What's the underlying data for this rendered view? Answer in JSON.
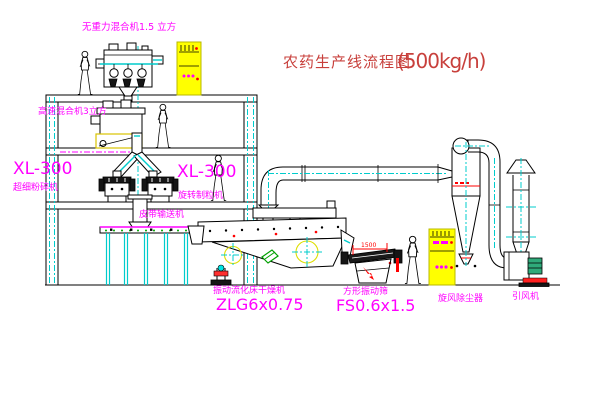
{
  "title": {
    "name": "农药生产线流程图",
    "capacity": "(500kg/h)"
  },
  "equipment_labels": {
    "zero_gravity_mixer": "无重力混合机1.5 立方",
    "high_speed_mixer": "高速混合机3立方",
    "pulverizer_model": "XL-300",
    "pulverizer_name": "超细粉碎机",
    "granulator_model": "XL-300",
    "granulator_name": "旋转制粒机",
    "belt_conveyor": "皮带输送机",
    "dryer_name": "振动流化床干燥机",
    "dryer_model": "ZLG6x0.75",
    "sieve_name": "方形振动筛",
    "sieve_model": "FS0.6x1.5",
    "cyclone": "旋风除尘器",
    "fan": "引风机"
  },
  "dimensions": {
    "sieve_length": "1500"
  },
  "colors": {
    "label_magenta": "#ff00ff",
    "title_red": "#c8403c",
    "accent_red": "#ff0000",
    "cabinet_yellow": "#ffff00",
    "centerline_cyan": "#00cccc",
    "line_black": "#000000",
    "motor_green": "#2faa7a"
  }
}
